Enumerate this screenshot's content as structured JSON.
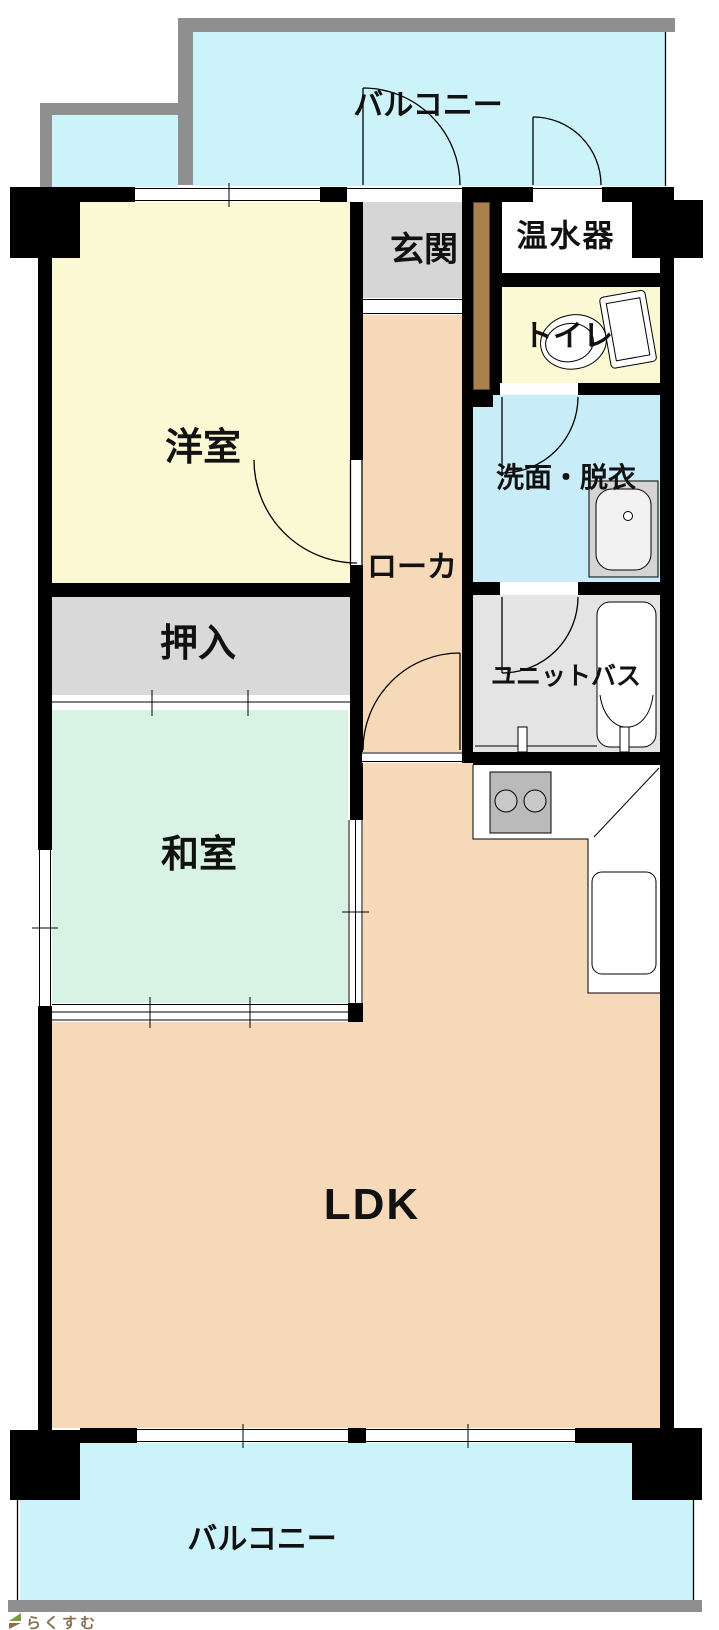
{
  "rooms": {
    "balcony_top": {
      "label": "バルコニー"
    },
    "youshitsu": {
      "label": "洋室"
    },
    "genkan": {
      "label": "玄関"
    },
    "onsuiki": {
      "label": "温水器"
    },
    "toilet": {
      "label": "トイレ"
    },
    "senmen": {
      "label": "洗面・脱衣"
    },
    "roka": {
      "label": "ローカ"
    },
    "oshiire": {
      "label": "押入"
    },
    "unit_bath": {
      "label": "ユニットバス"
    },
    "washitsu": {
      "label": "和室"
    },
    "ldk": {
      "label": "LDK"
    },
    "balcony_bottom": {
      "label": "バルコニー"
    }
  },
  "watermark": {
    "text": "らくすむ"
  },
  "colors": {
    "c-balcony": "#ccf3f9",
    "c-senmen": "#c9edf8",
    "c-yellow": "#fbf8d4",
    "c-green": "#d8f3e3",
    "c-peach": "#f5d9b8",
    "c-gray1": "#d9d9d9",
    "c-gray2": "#d6d6d6",
    "c-gray3": "#e4e4e4",
    "c-wall": "#000000",
    "c-rail": "#8f8f8f",
    "c-stove": "#bababa",
    "c-brown": "#a8814c",
    "c-footer": "#8f8f8f",
    "c-text": "#111111",
    "c-logo": "#8a6f52"
  }
}
